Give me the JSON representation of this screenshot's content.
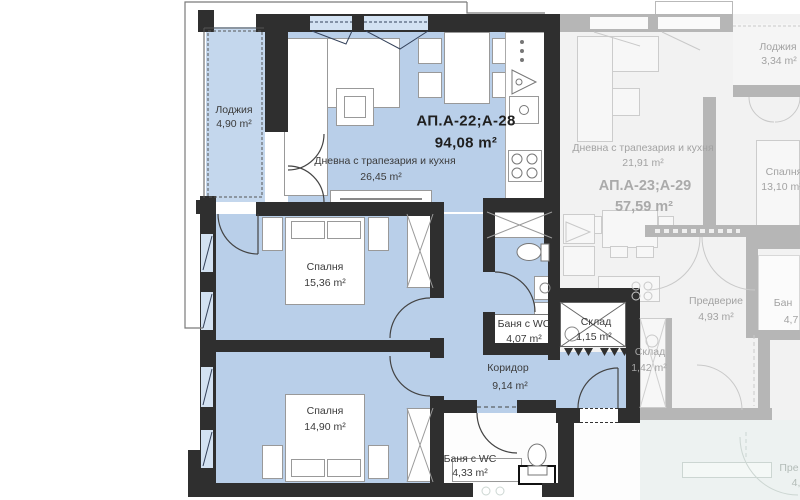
{
  "apartments": {
    "main": {
      "title": "АП.А-22;А-28",
      "area": "94,08 m²",
      "loggia": {
        "name": "Лоджия",
        "area": "4,90 m²"
      },
      "living": {
        "name": "Дневна с трапезария и кухня",
        "area": "26,45 m²"
      },
      "bedroom1": {
        "name": "Спалня",
        "area": "15,36 m²"
      },
      "bedroom2": {
        "name": "Спалня",
        "area": "14,90 m²"
      },
      "bath1": {
        "name": "Баня с WC",
        "area": "4,07 m²"
      },
      "storage": {
        "name": "Склад",
        "area": "1,15 m²"
      },
      "corridor": {
        "name": "Коридор",
        "area": "9,14 m²"
      },
      "bath2": {
        "name": "Баня с WC",
        "area": "4,33 m²"
      }
    },
    "adjacent": {
      "title": "АП.А-23;А-29",
      "area": "57,59 m²",
      "loggia": {
        "name": "Лоджия",
        "area": "3,34 m²"
      },
      "living": {
        "name": "Дневна с трапезария и кухня",
        "area": "21,91 m²"
      },
      "bedroom": {
        "name": "Спалня",
        "area": "13,10 m²"
      },
      "hall": {
        "name": "Предверие",
        "area": "4,93 m²"
      },
      "storage": {
        "name": "Склад",
        "area": "1,42 m²"
      },
      "bath": {
        "name": "Бан",
        "area": "4,7"
      }
    },
    "lower_partial": {
      "name": "Пре",
      "area": "4,"
    }
  },
  "colors": {
    "floor_blue": "#b9cfe9",
    "wall_dark": "#2f2f2f",
    "faded_wall": "#b6b6b6",
    "lower_tint": "#edf2f1"
  }
}
